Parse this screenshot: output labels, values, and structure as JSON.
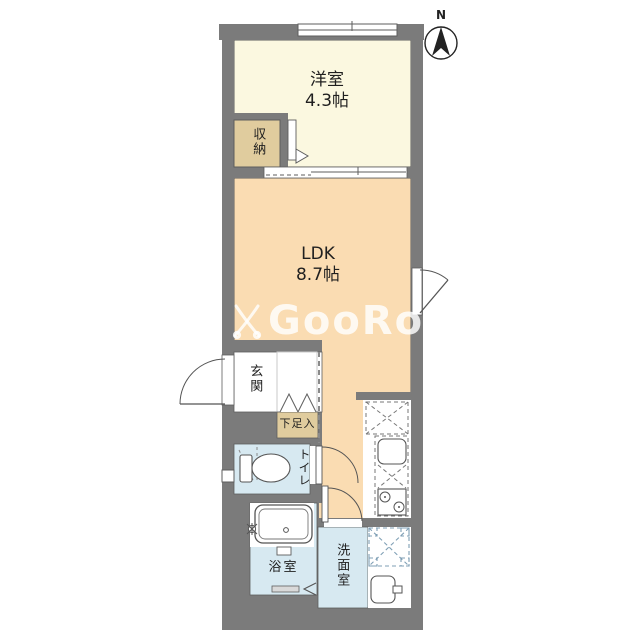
{
  "plan": {
    "type": "floor-plan",
    "compass": {
      "north_label": "N"
    },
    "watermark": {
      "text": "GooRooM"
    },
    "rooms": {
      "western_room": {
        "name": "洋室",
        "size": "4.3帖"
      },
      "ldk": {
        "name": "LDK",
        "size": "8.7帖"
      },
      "closet": {
        "name": "収納"
      },
      "entrance": {
        "name": "玄関"
      },
      "shoe_box": {
        "name": "下足入"
      },
      "toilet": {
        "name": "トイレ"
      },
      "bathroom": {
        "name": "浴室"
      },
      "washroom": {
        "name": "洗面室"
      }
    },
    "colors": {
      "wall": "#7b7b7b",
      "western_room_floor": "#fbf8e0",
      "ldk_floor": "#fadcb2",
      "closet_floor": "#e0cc9e",
      "wet_area_floor": "#d7e9f1",
      "outline": "#5e5e5e"
    }
  }
}
